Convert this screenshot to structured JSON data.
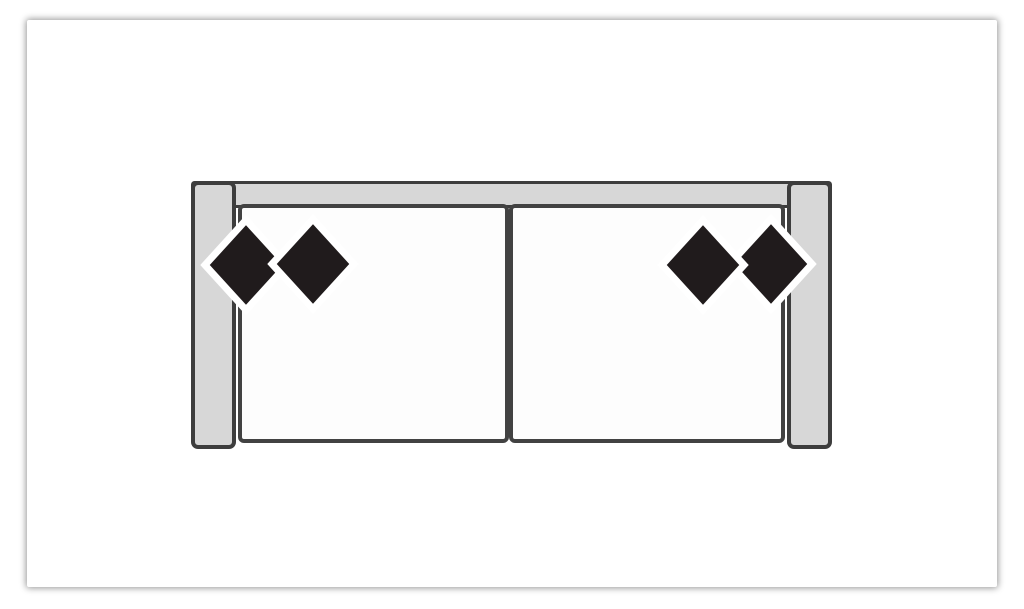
{
  "page": {
    "background": "#ffffff"
  },
  "card": {
    "background": "#ffffff"
  },
  "sofa_diagram": {
    "description": "Top-down plan view of a two-seat sofa: light gray backrest bar and side armrests, two white seat cushions divided in the middle, with two pairs of black diamond-shaped accent pillows (one pair at the left armrest, one pair at the right armrest).",
    "colors": {
      "frame_fill": "#d7d7d7",
      "frame_border": "#3d3d3d",
      "seat_fill": "#fdfdfd",
      "seat_border": "#424242",
      "pillow_fill": "#201b1c",
      "pillow_outline": "#ffffff"
    },
    "parts": {
      "backrest": "backrest",
      "armrest_left": "left armrest",
      "armrest_right": "right armrest",
      "seat_left": "left seat cushion",
      "seat_right": "right seat cushion",
      "pillow_left_outer": "left pair outer diamond pillow",
      "pillow_left_inner": "left pair inner diamond pillow",
      "pillow_right_outer": "right pair outer diamond pillow",
      "pillow_right_inner": "right pair inner diamond pillow"
    }
  }
}
